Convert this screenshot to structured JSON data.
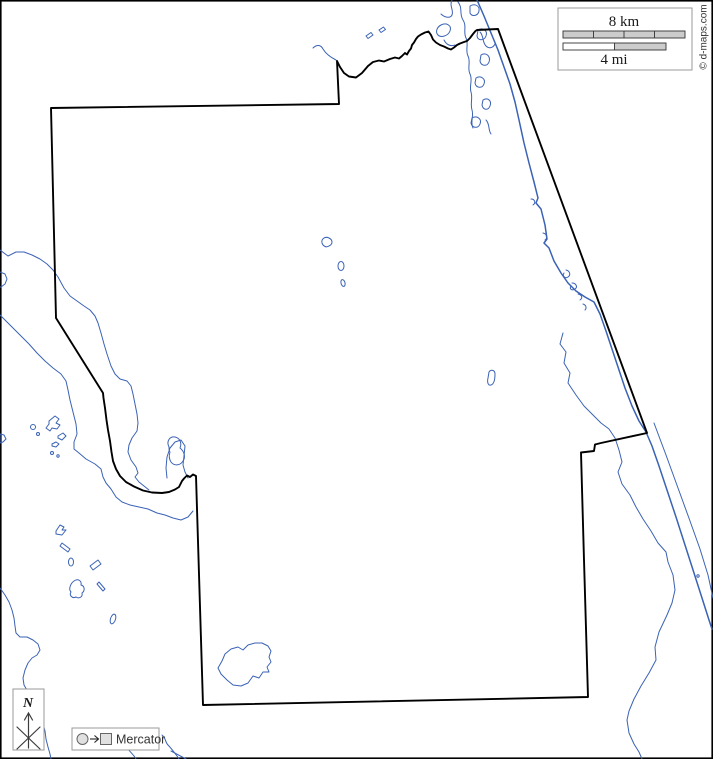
{
  "map": {
    "credit": "© d-maps.com",
    "scale_box": {
      "km_label": "8 km",
      "mi_label": "4 mi"
    },
    "compass": {
      "north_label": "N"
    },
    "projection_box": {
      "label": "Mercator"
    },
    "colors": {
      "boundary": "#000000",
      "water": "#3a62b5",
      "scale_fill": "#cccccc",
      "box_border": "#999999",
      "text_dark": "#1a1a1a",
      "background": "#ffffff"
    }
  }
}
